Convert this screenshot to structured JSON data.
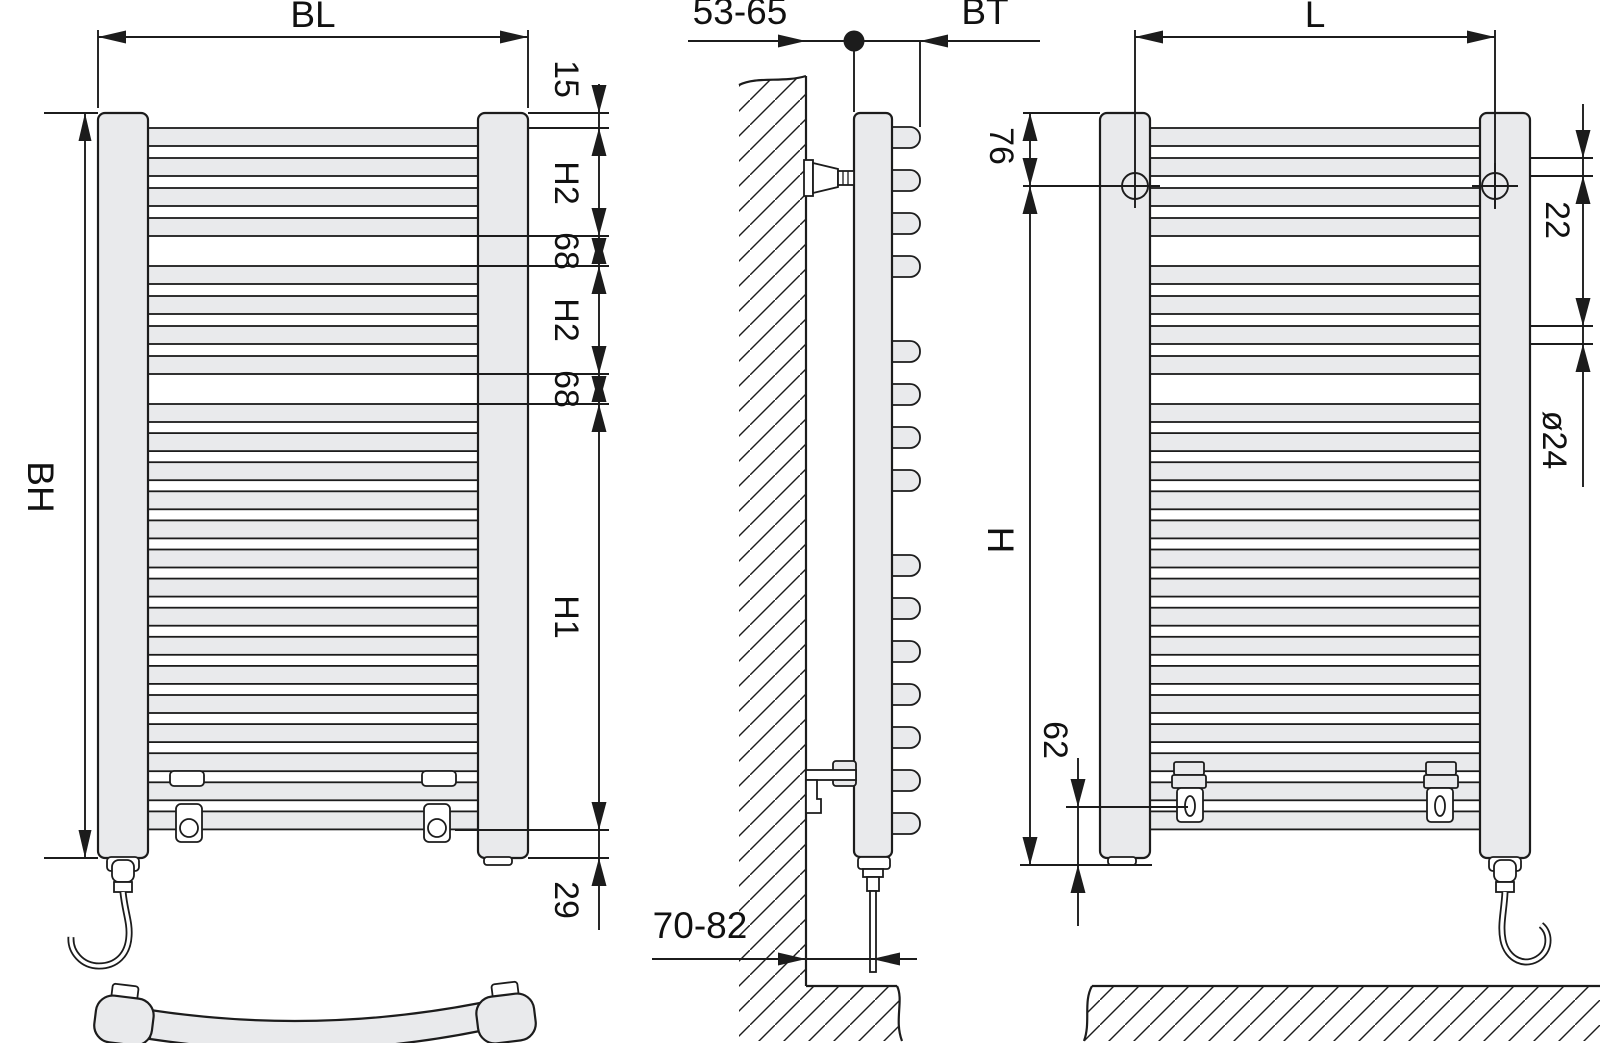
{
  "diagram": {
    "type": "technical installation drawing",
    "subject": "curved bathroom towel radiator with electric heating element, three views with mounting dimensions",
    "colors": {
      "line": "#1c1c1c",
      "part_fill": "#e9eaec",
      "background": "#ffffff"
    },
    "views": {
      "front": {
        "name": "front view",
        "dimensions": {
          "overall_width": "BL",
          "overall_height": "BH",
          "post_top_to_first_tube": "15",
          "upper_tube_group_height": "H2",
          "tube_group_gap_1": "68",
          "middle_tube_group_height": "H2",
          "tube_group_gap_2": "68",
          "lower_tube_group_height": "H1",
          "last_tube_to_post_end": "29"
        }
      },
      "side": {
        "name": "side view at wall",
        "dimensions": {
          "wall_to_anchor": "53-65",
          "anchor_to_front_depth": "BT",
          "wall_to_element_outlet": "70-82"
        }
      },
      "back": {
        "name": "rear view with mounting points",
        "dimensions": {
          "mounting_hole_spacing": "L",
          "post_top_to_mounting_hole": "76",
          "tube_diameter": "22",
          "collector_tube_diameter": "ø24",
          "mounting_hole_to_bracket_slot": "H",
          "bracket_slot_to_post_end": "62"
        }
      }
    }
  }
}
